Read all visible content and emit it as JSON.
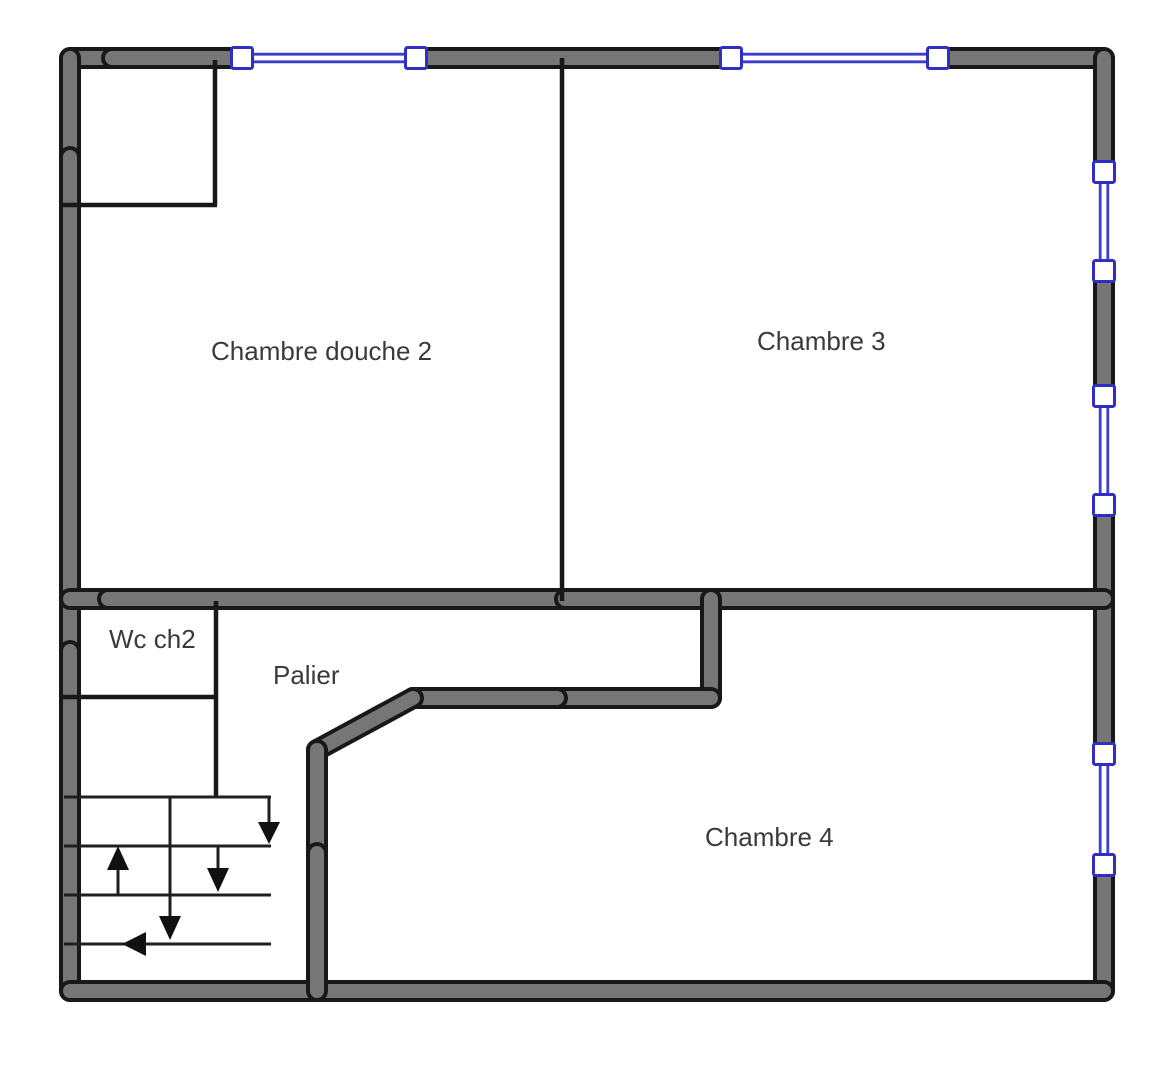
{
  "floor_plan": {
    "rooms": [
      {
        "name": "chambre-douche-2",
        "label": "Chambre douche 2"
      },
      {
        "name": "chambre-3",
        "label": "Chambre 3"
      },
      {
        "name": "wc-ch2",
        "label": "Wc ch2"
      },
      {
        "name": "palier",
        "label": "Palier"
      },
      {
        "name": "chambre-4",
        "label": "Chambre 4"
      }
    ],
    "colors": {
      "wall_fill": "#767676",
      "wall_outline": "#181818",
      "window_accent": "#3c3cd0",
      "window_box_border": "#2f2fc4",
      "background": "#ffffff",
      "label_text": "#3a3a3a"
    },
    "windows": [
      {
        "location": "top-wall-left"
      },
      {
        "location": "top-wall-right"
      },
      {
        "location": "right-wall-upper"
      },
      {
        "location": "right-wall-middle"
      },
      {
        "location": "right-wall-lower"
      }
    ],
    "stairs": {
      "arrow_directions": [
        "down",
        "down",
        "down",
        "up",
        "left"
      ]
    }
  }
}
